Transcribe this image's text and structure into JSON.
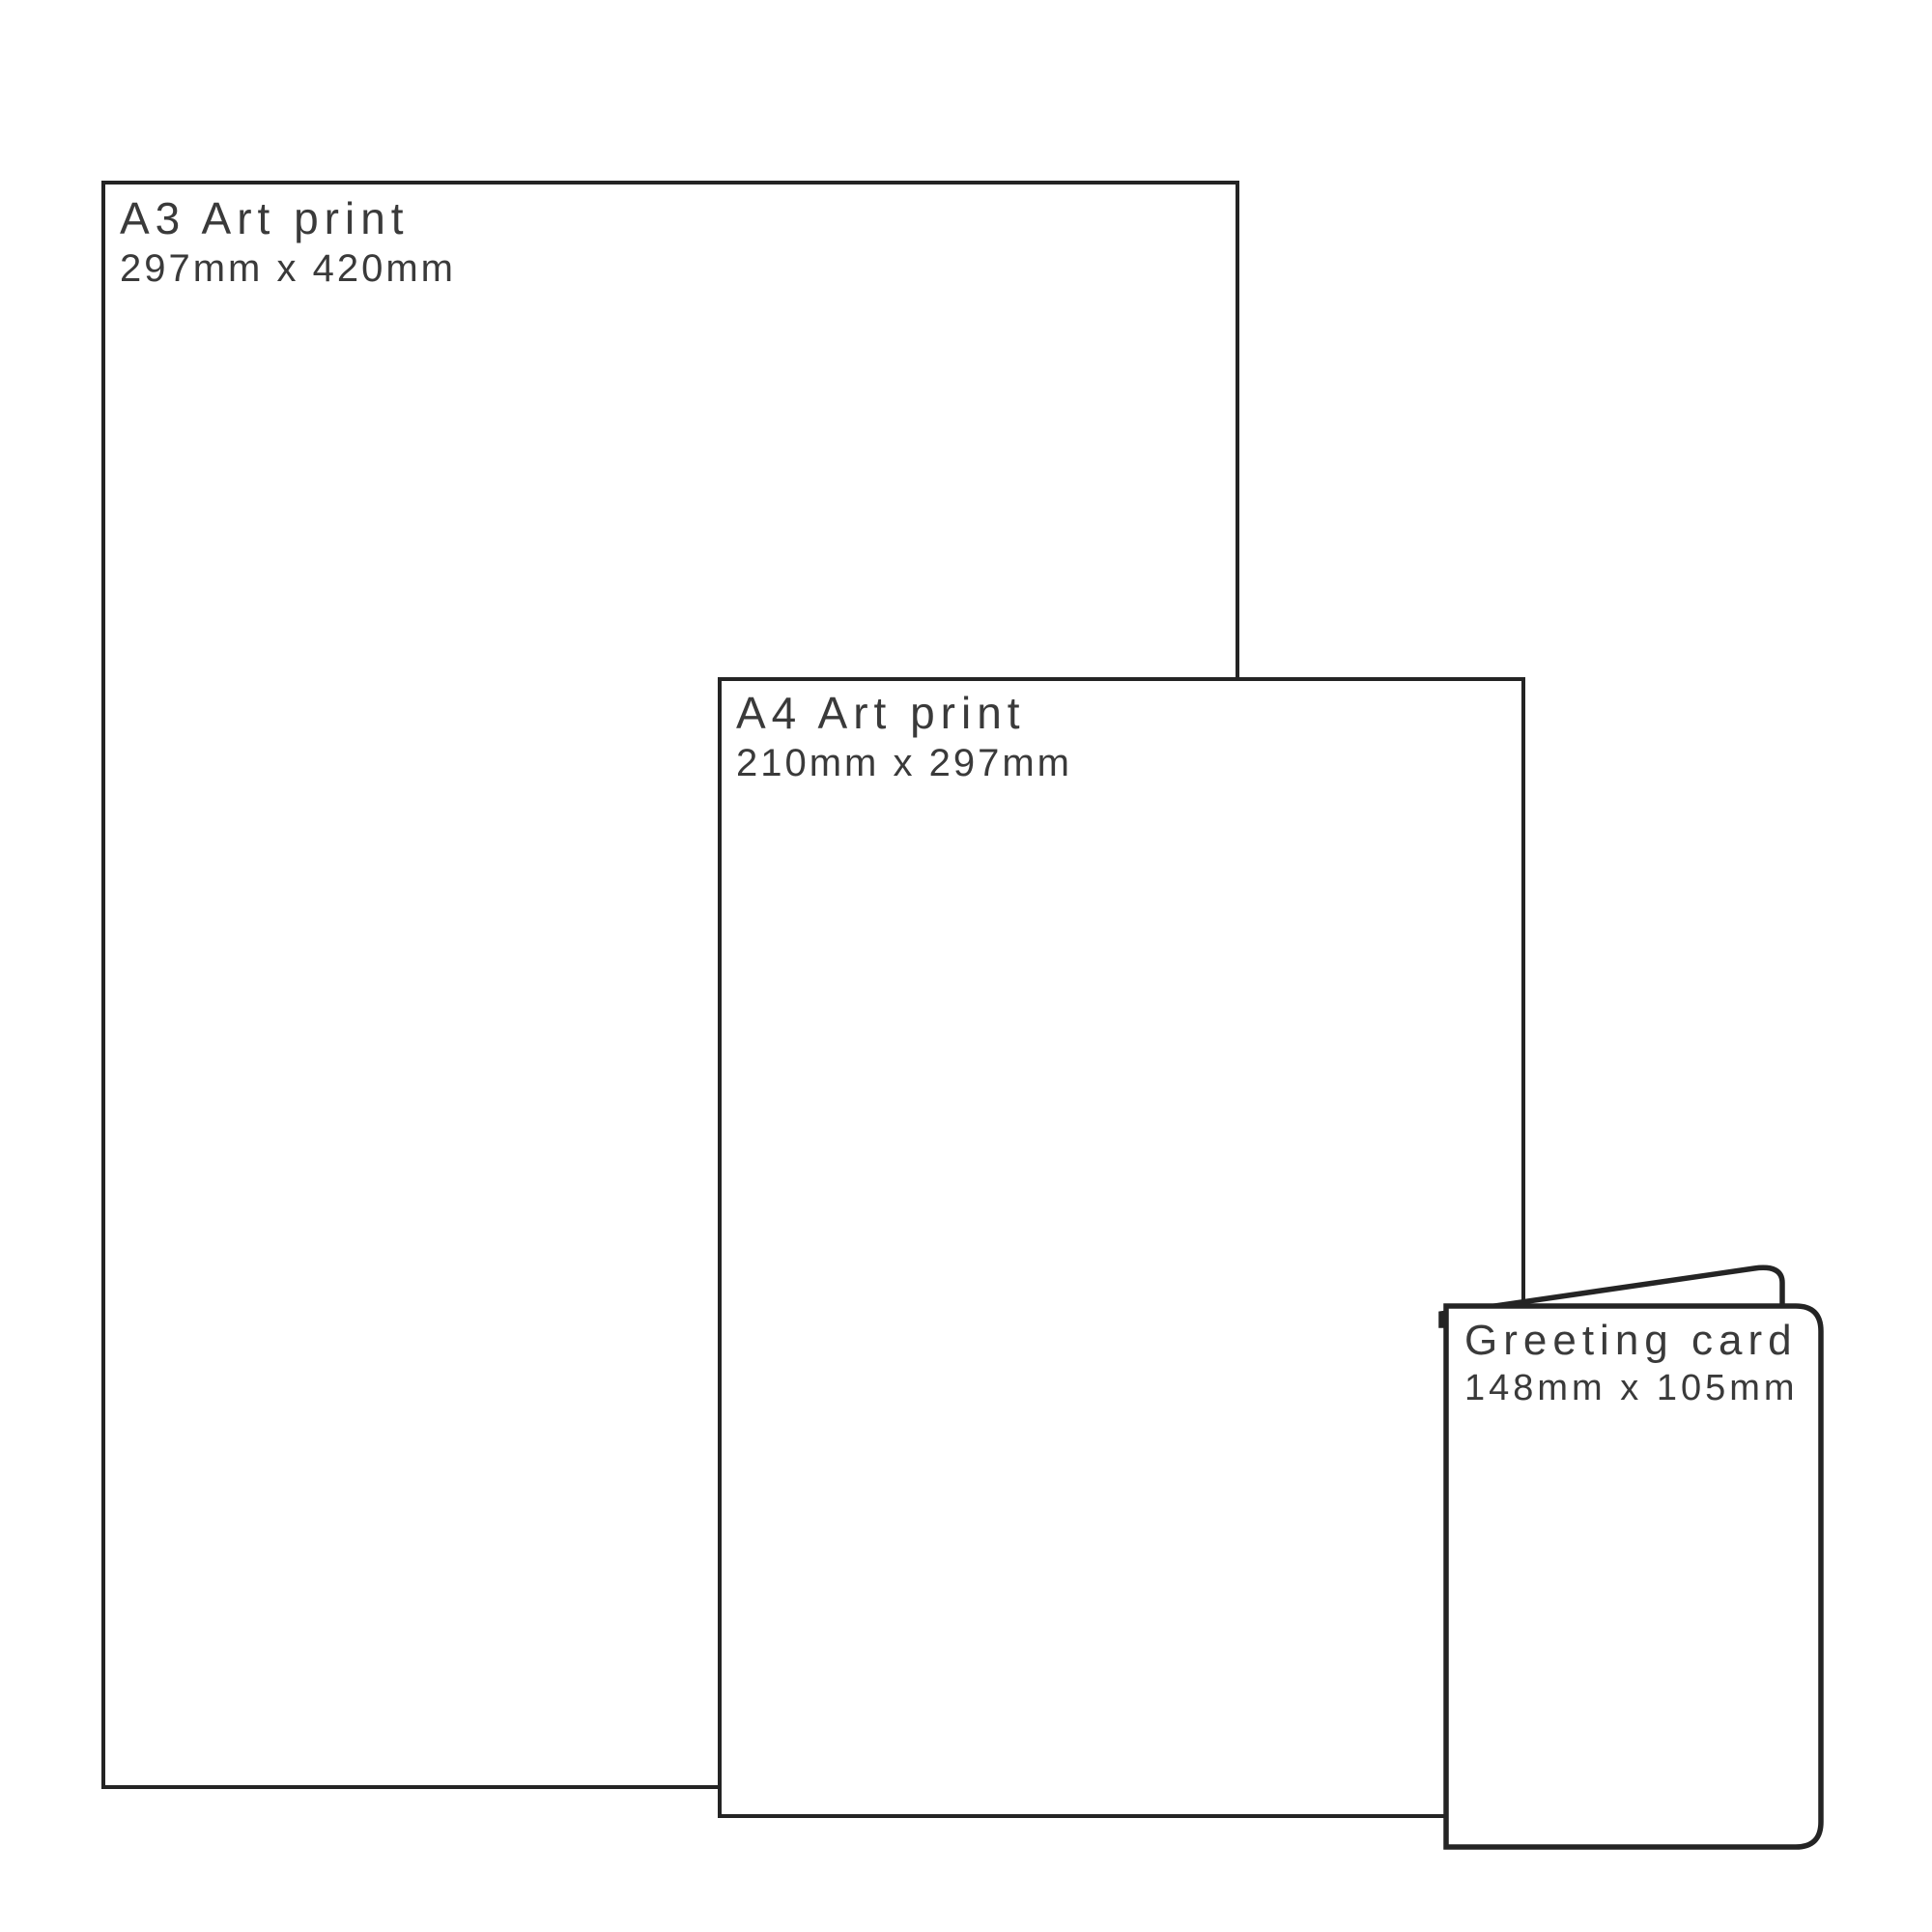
{
  "page": {
    "background": "#ffffff"
  },
  "colors": {
    "outline": "#242424",
    "label_text": "#3a3a3a",
    "fill": "#ffffff"
  },
  "items": [
    {
      "id": "a3-print",
      "title": "A3 Art print",
      "dimensions": "297mm x 420mm"
    },
    {
      "id": "a4-print",
      "title": "A4 Art print",
      "dimensions": "210mm x 297mm"
    },
    {
      "id": "greeting-card",
      "title": "Greeting card",
      "dimensions": "148mm x 105mm"
    }
  ]
}
